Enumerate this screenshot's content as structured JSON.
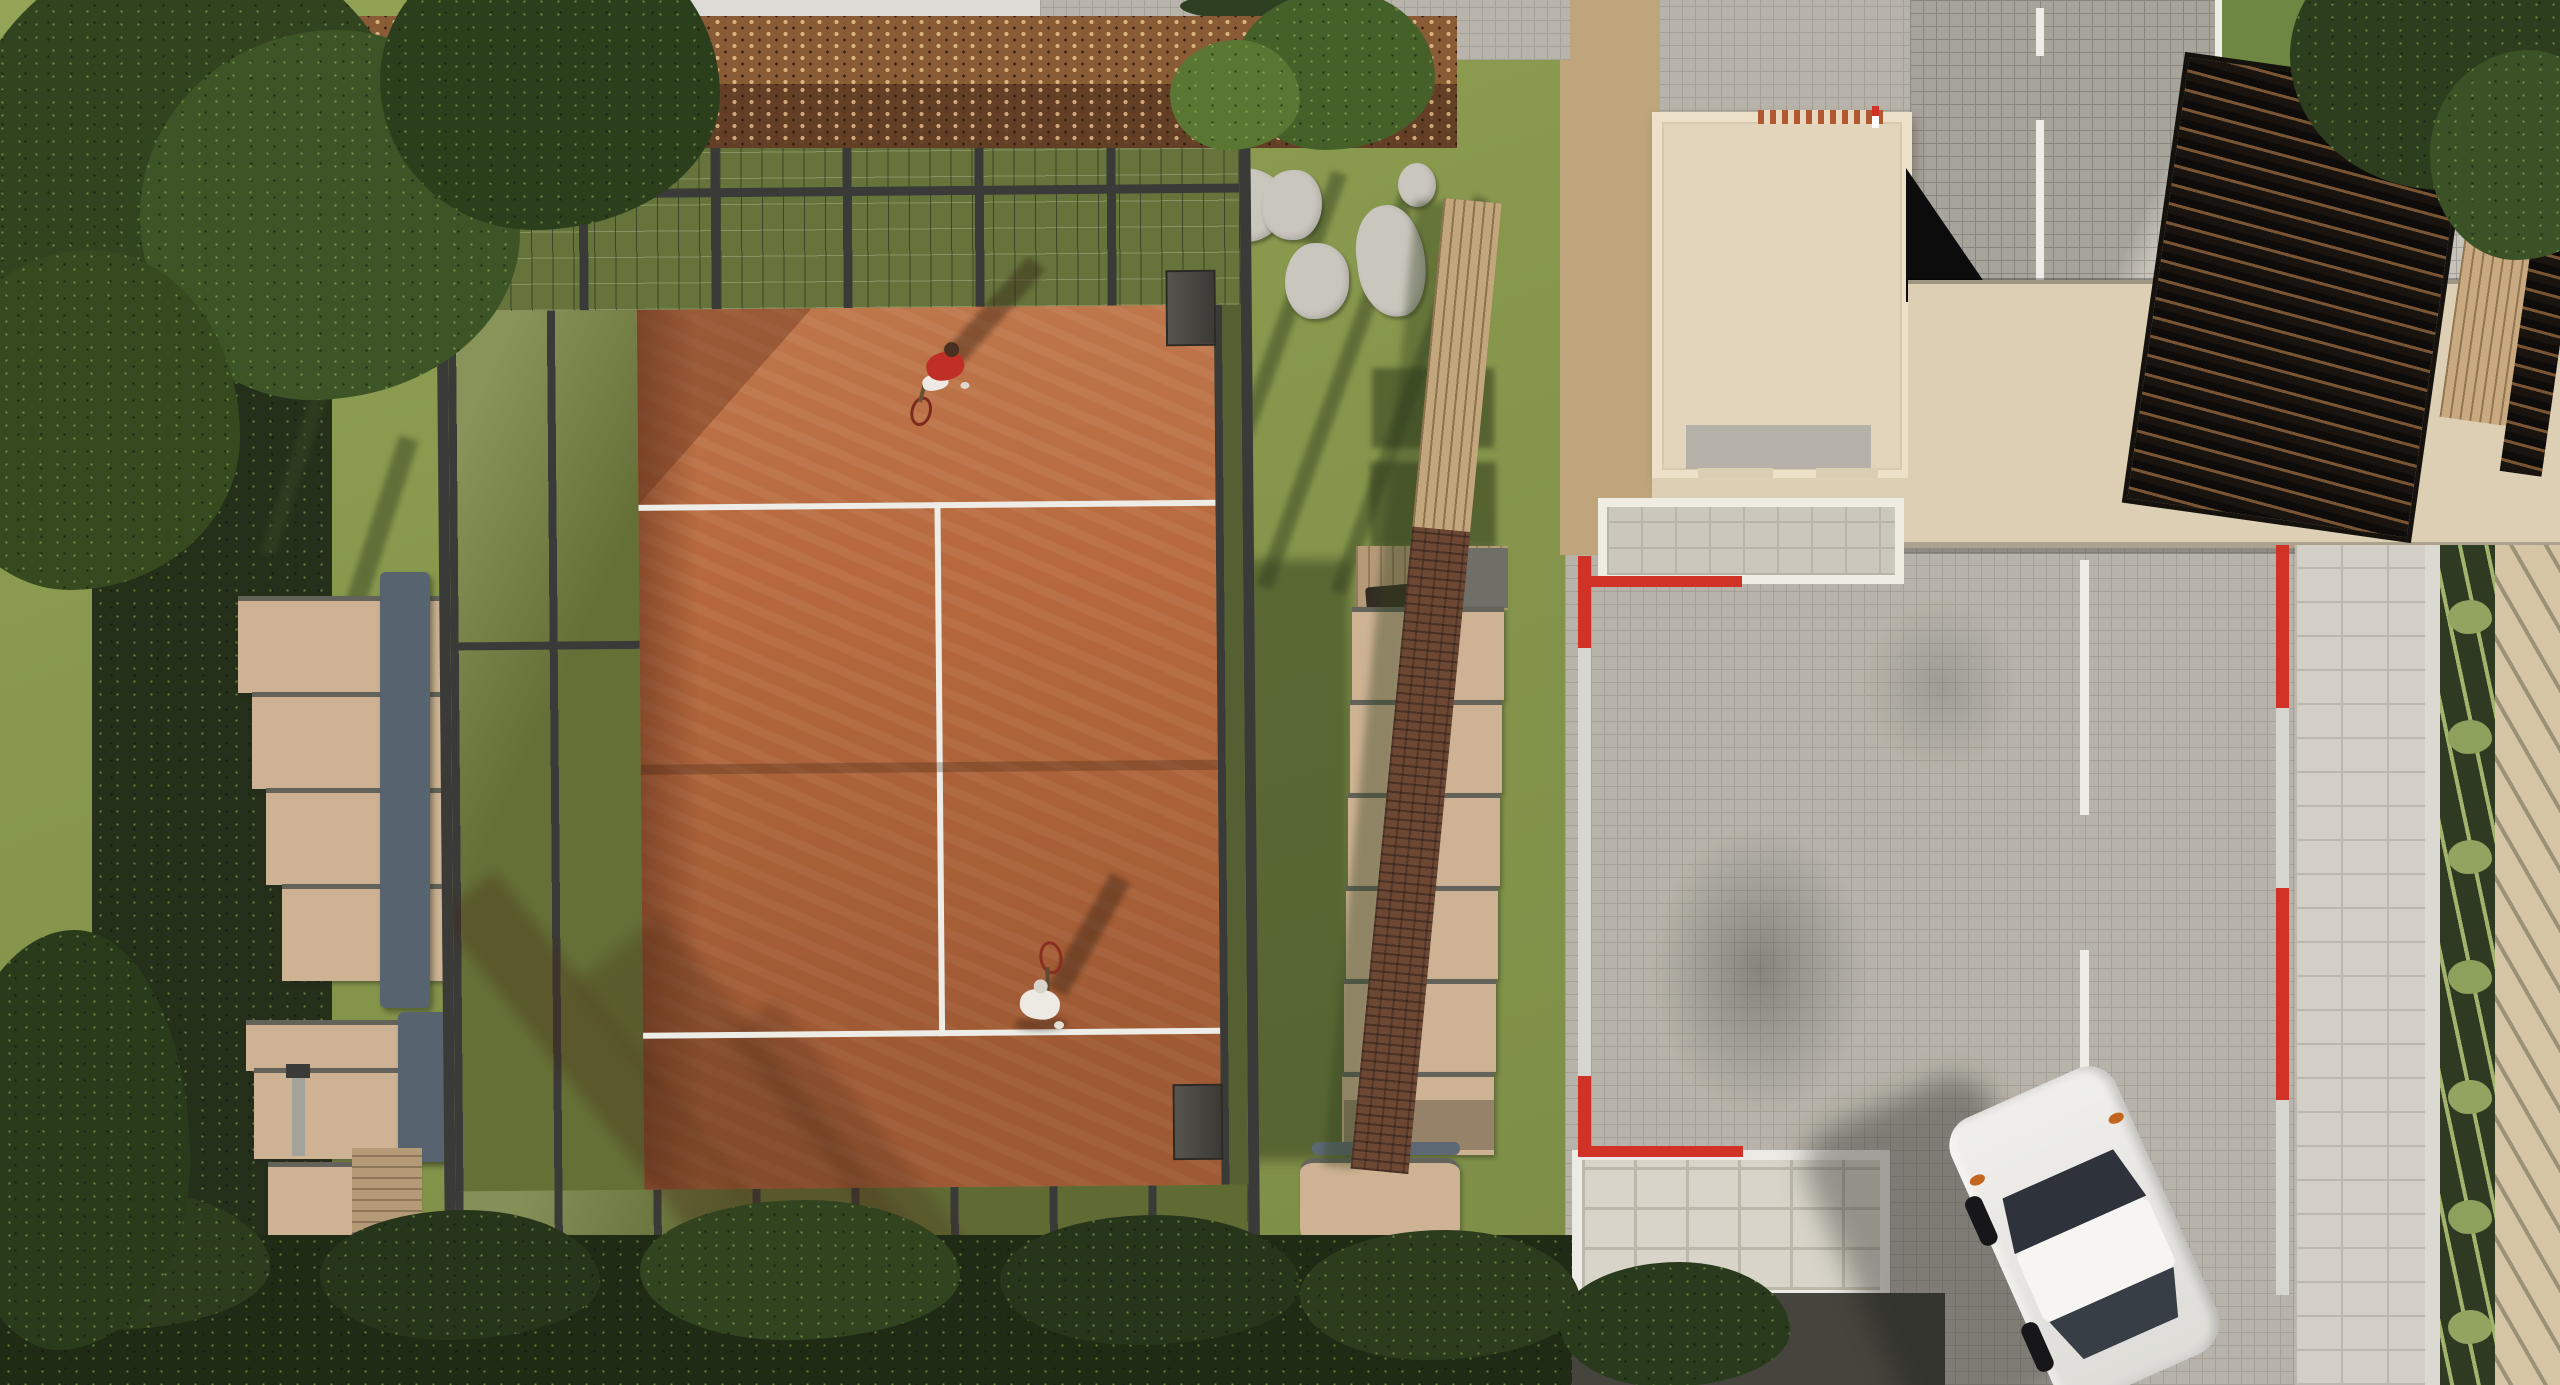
{
  "scene": {
    "title": "Aerial top-down 3D architectural rendering of a padel club",
    "type": "3d-render-top-view",
    "elements": [
      "padel court with terracotta clay surface, white lines and glass/steel enclosure",
      "player in red shirt on upper half of court",
      "player in white outfit on lower half of court",
      "staggered tan herringbone sun loungers on the left lawn",
      "column of tan herringbone sun loungers on the right lawn",
      "slate blue garden benches",
      "corten-steel perforated pergola band along the top",
      "swimming pool sliver at the very top",
      "grey stepping stones on lawn",
      "small wooden deck with dark grill table",
      "dark brick garden wall",
      "clubhouse with cream parapet roof",
      "beige entrance canopy roof",
      "dark timber slatted pergola at the top right",
      "cobblestone parking plaza with white bay lines",
      "red and white painted kerb poles",
      "stone tile walkway with spiky planter bed",
      "white-framed stone patios",
      "dark asphalt drive strip",
      "white parked car seen from above",
      "dense trees and shrub borders"
    ]
  },
  "palette": {
    "grass": "#87984d",
    "grassDark": "#5f7236",
    "hedge": "#24301a",
    "treeDark": "#31441f",
    "treeMid": "#46602a",
    "treeLight": "#7da047",
    "clay": "#b7693d",
    "clayDark": "#9a5530",
    "clayShadow": "#7e432a",
    "frame": "#3a3a38",
    "glass": "#76823f",
    "courtLine": "#f2efe6",
    "tan": "#cdb293",
    "benchBlue": "#57636e",
    "wood": "#b59a78",
    "brick": "#6b4734",
    "tanWall": "#c3a77c",
    "corten": "#8a5c36",
    "cortenDark": "#5f3d24",
    "roof": "#e3d5bb",
    "roofEdge": "#ece0c8",
    "canopy": "#ddcfb4",
    "cobble": "#b7b3aa",
    "cobbleLight": "#c7c3ba",
    "cobbleLine": "#a5a198",
    "path": "#d3cfc6",
    "asphalt": "#45453d",
    "red": "#d03326",
    "white": "#edece6",
    "poleGray": "#d6d6d0",
    "carBody": "#f0efec",
    "carGlass": "#2e333b",
    "planter": "#2e3a22",
    "plant": "#a3b26c",
    "beige": "#d6c5a4",
    "stone": "#c9c6be",
    "pool": "#7fb3cc",
    "plank": "#c9aa80",
    "grill": "#322b22",
    "shirtRed": "#bf2f26",
    "outfitWhite": "#eceae2"
  }
}
